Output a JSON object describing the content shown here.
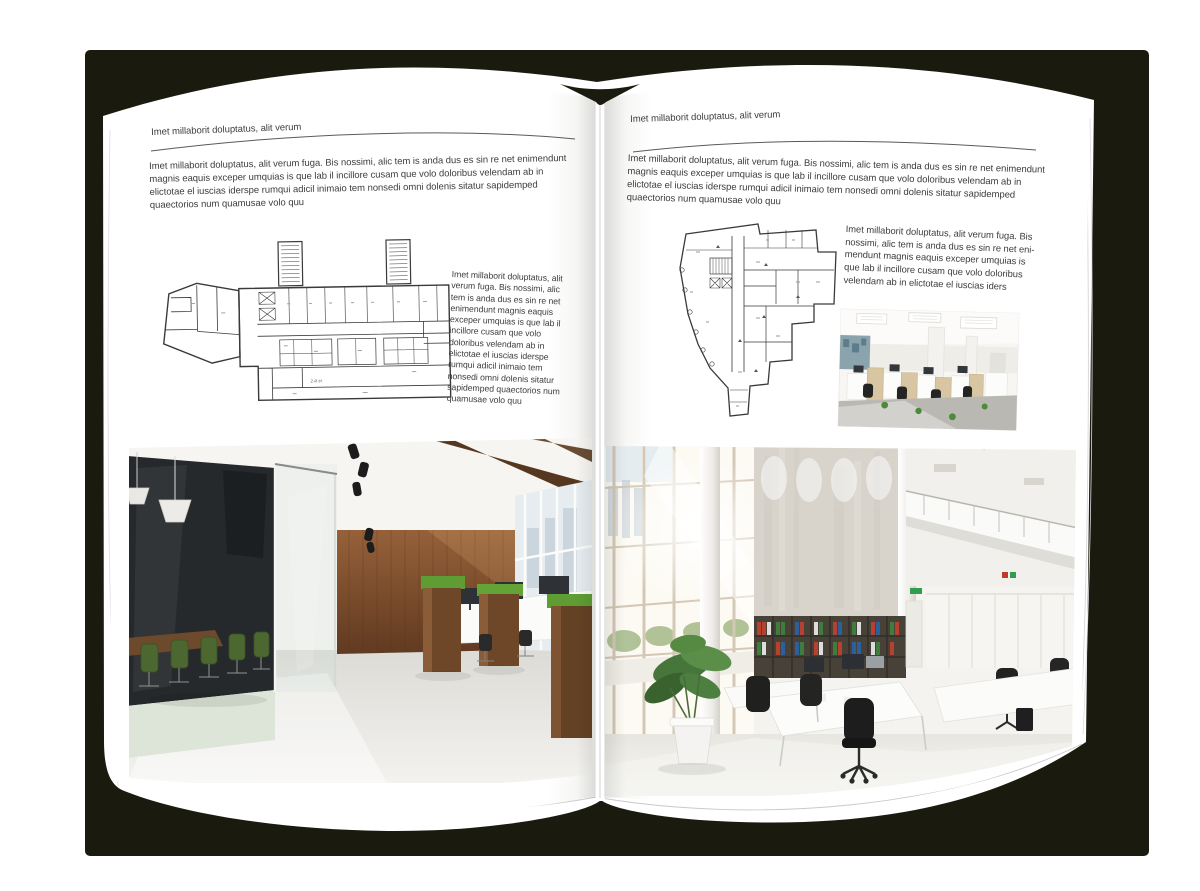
{
  "background": {
    "canvas_color": "#ffffff",
    "shadow_color": "#1a1b0e"
  },
  "book": {
    "left_page": {
      "header": "Imet millaborit doluptatus, alit verum",
      "intro": "Imet millaborit doluptatus, alit verum fuga. Bis nossimi, alic tem is anda dus es sin re net enimendunt magnis eaquis exceper umquias is que lab il incillore cusam que volo doloribus velendam ab in elictotae el iuscias iderspe rumqui adicil inimaio tem nonsedi omni dolenis sitatur sapidemped quaectorios num quamusae volo quu",
      "floor_plan_caption": "2-й эт",
      "side_text": "Imet millaborit doluptatus, alit verum fuga. Bis nossimi, alic tem is anda dus es sin re net enimendunt magnis eaquis exceper umquias is que lab il incillore cusam que volo doloribus velendam ab in elictotae el iuscias iderspe rumqui adicil inimaio tem nonsedi omni dolenis sitatur sapidemped quaectorios num quamusae volo quu",
      "photo_description": "Loft office interior with dark glass meeting room, green chairs, wooden wall and white workstations"
    },
    "right_page": {
      "header": "Imet millaborit doluptatus, alit verum",
      "intro": "Imet millaborit doluptatus, alit verum fuga. Bis nossimi, alic tem is anda dus es sin re net enimendunt magnis eaquis exceper umquias is que lab il incillore cusam que volo doloribus velendam ab in elictotae el iuscias iderspe rumqui adicil inimaio tem nonsedi omni dolenis sitatur sapidemped quaectorios num quamusae volo quu",
      "side_text": "Imet millaborit doluptatus, alit verum fuga. Bis nossimi, alic tem is anda dus es sin re net eni-mendunt magnis eaquis exceper umquias is que lab il incillore cusam que volo doloribus velendam ab in elictotae el iuscias iders",
      "photo_small_description": "Bright open-plan office with light wood cubicle workstations",
      "photo_description": "Double-height white office with window wall, concrete feature wall, shelving with colored binders and white desks"
    }
  }
}
